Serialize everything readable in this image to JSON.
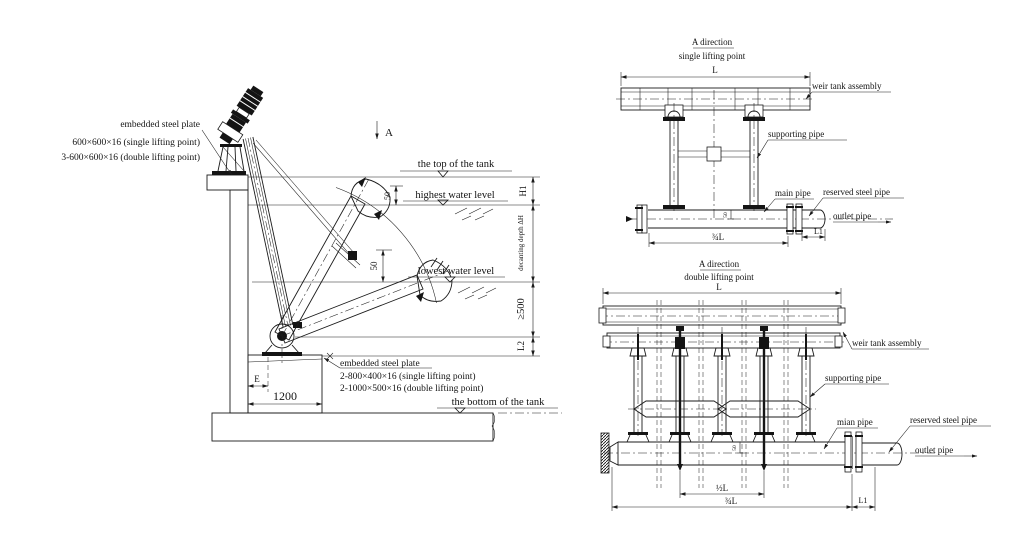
{
  "colors": {
    "background": "#ffffff",
    "line": "#1b1b1b"
  },
  "side_view": {
    "section_label": "A",
    "plate_top": {
      "title": "embedded steel plate",
      "spec_single": "600×600×16 (single lifting point)",
      "spec_double": "3-600×600×16 (double lifting point)"
    },
    "plate_bottom": {
      "title": "embedded steel plate",
      "spec_single": "2-800×400×16 (single lifting point)",
      "spec_double": "2-1000×500×16 (double lifting point)"
    },
    "levels": {
      "top": "the top of the tank",
      "highest": "highest water level",
      "lowest": "lowest water level",
      "bottom": "the bottom of the tank"
    },
    "dims": {
      "h1": "H1",
      "decanting": "decanting depth ΔH",
      "min_depth": "≥500",
      "l2": "L2",
      "offset_50_upper": "50",
      "offset_50_lower": "50",
      "e": "E",
      "base_width": "1200"
    }
  },
  "single_view": {
    "title_line1": "A direction",
    "title_line2": "single lifting point",
    "labels": {
      "weir": "weir tank assembly",
      "supporting": "supporting pipe",
      "main": "main pipe",
      "reserved": "reserved steel pipe",
      "outlet": "outlet pipe"
    },
    "dims": {
      "span": "L",
      "to_outlet": "¾L",
      "l1": "L1",
      "drop": "50"
    }
  },
  "double_view": {
    "title_line1": "A direction",
    "title_line2": "double lifting point",
    "labels": {
      "weir": "weir tank assembly",
      "supporting": "supporting pipe",
      "main": "mian pipe",
      "reserved": "reserved steel pipe",
      "outlet": "outlet pipe"
    },
    "dims": {
      "span": "L",
      "half": "½L",
      "to_outlet": "¾L",
      "l1": "L1",
      "drop": "50"
    }
  }
}
